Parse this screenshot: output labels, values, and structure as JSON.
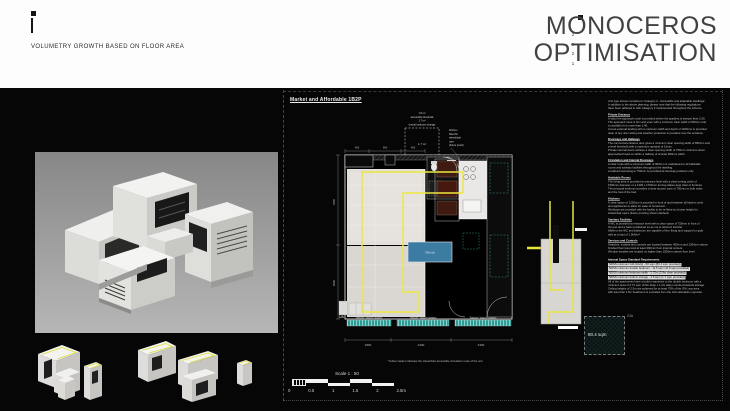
{
  "header": {
    "subtitle": "VOLUMETRY GROWTH BASED ON FLOOR AREA",
    "title_line1": "MONOCEROS",
    "title_line2": "OPTIMISATION",
    "year_digits": [
      "2",
      "0",
      "2",
      "1"
    ]
  },
  "colors": {
    "accent_yellow": "#E8E33E",
    "window_teal": "#35A39A",
    "furniture_blue": "#3C7BA2",
    "kitchen_red": "#3E1A10",
    "render_grey": "#9B9B9B"
  },
  "plan": {
    "title": "Market and Affordable 1B2P",
    "ua": "UA",
    "window_label": "Window / balcony location",
    "blue_label": "750 min",
    "storage_box_label": "1.7 m²",
    "storage_notes": [
      "1.5 m²",
      "accessible threshold",
      "1.7 m²",
      "(extra) bedroom storage"
    ],
    "kitchen_note": [
      "Kitchen",
      "fitted for",
      "wheelchair",
      "user",
      "(future proof)"
    ],
    "dims_bottom": [
      "1800",
      "2400",
      "2300"
    ],
    "dims_left": [
      "3450",
      "2900"
    ],
    "dims_top": [
      "450",
      "900",
      "450"
    ]
  },
  "scalebar": {
    "label": "Scale 1 : 50",
    "ticks": [
      "0",
      "0.5",
      "1",
      "1.5",
      "2",
      "2.5m"
    ]
  },
  "note": "*Yellow marker indicates the wheelchair accessible circulation route of the unit",
  "gia_square": {
    "label": "80.4 sqm",
    "corner": "GIA"
  },
  "annotations": {
    "items": [
      {
        "cls": "al",
        "text": "Unit type shown complies to 'Category 2 - Accessible and adaptable dwellings'."
      },
      {
        "cls": "al",
        "text": "In addition to the above planning, please note that the following regulations"
      },
      {
        "cls": "al",
        "text": "have been adhered to with Category 2 implemented throughout the scheme."
      },
      {
        "cls": "ah",
        "text": "Private Entrance"
      },
      {
        "cls": "al",
        "text": "A step free approach route is provided where the gradient is steeper than 1:60."
      },
      {
        "cls": "al",
        "text": "The approach route is firm and even with a minimum clear width of 900mm and"
      },
      {
        "cls": "al",
        "text": "a crossfall of no more than 1:40."
      },
      {
        "cls": "al",
        "text": "A level external landing with a minimum width and depth of 1200mm is provided"
      },
      {
        "cls": "al",
        "text": "clear of any door swing and weather protection is provided over the entrance."
      },
      {
        "cls": "ah",
        "text": "Doorways and Hallways"
      },
      {
        "cls": "al",
        "text": "The communal entrance door gives a minimum clear opening width of 850mm and"
      },
      {
        "cls": "al",
        "text": "a level threshold with a maximum upstand of 15mm."
      },
      {
        "cls": "al",
        "text": "Private internal doors achieve a clear opening width of 750mm minimum when"
      },
      {
        "cls": "al",
        "text": "approached head-on within a hallway of at least 900mm width."
      },
      {
        "cls": "ah",
        "text": "Circulation and Internal Doorways"
      },
      {
        "cls": "al",
        "text": "A clear route with a minimum width of 900mm is maintained to all habitable"
      },
      {
        "cls": "al",
        "text": "rooms and sanitary facilities throughout the dwelling."
      },
      {
        "cls": "al",
        "text": "Localised narrowing to 750mm is permitted at doorway positions only."
      },
      {
        "cls": "ah",
        "text": "Habitable Rooms"
      },
      {
        "cls": "al",
        "text": "The living area is provided at entrance level with a clear turning circle of"
      },
      {
        "cls": "al",
        "text": "1500mm diameter or a 1400 x 1700mm turning ellipse kept clear of furniture."
      },
      {
        "cls": "al",
        "text": "The principal bedroom provides a clear access zone of 750mm to both sides"
      },
      {
        "cls": "al",
        "text": "and the foot of the bed."
      },
      {
        "cls": "ah",
        "text": "Kitchens"
      },
      {
        "cls": "al",
        "text": "A clear space of 1200mm is provided in front of and between all kitchen units"
      },
      {
        "cls": "al",
        "text": "and appliances to allow for ease of movement."
      },
      {
        "cls": "al",
        "text": "Worktops are provided with the facility to be re-fitted at a lower height for"
      },
      {
        "cls": "al",
        "text": "wheelchair users (future proofing shown dashed)."
      },
      {
        "cls": "ah",
        "text": "Sanitary Facilities"
      },
      {
        "cls": "al",
        "text": "A WC is provided at entrance level with a clear space of 750mm in front of"
      },
      {
        "cls": "al",
        "text": "the pan and a basin positioned so as not to obstruct transfer."
      },
      {
        "cls": "al",
        "text": "Walls to the WC and bathroom are capable of firm fixing and support for grab"
      },
      {
        "cls": "al",
        "text": "rails at a load of 1.5kN/m²."
      },
      {
        "cls": "ah",
        "text": "Services and Controls"
      },
      {
        "cls": "al",
        "text": "Switches, sockets and controls are located between 450mm and 1200mm above"
      },
      {
        "cls": "al",
        "text": "finished floor level and at least 300mm from internal corners."
      },
      {
        "cls": "al",
        "text": "Window handles are located no higher than 1200mm above floor level."
      },
      {
        "cls": "ah2",
        "text": "Internal Space Standard Requirements"
      },
      {
        "cls": "hl",
        "text": "NDSS minimum GIA (1b2p) - 50 sqm (80.4 sqm provided)"
      },
      {
        "cls": "hl",
        "text": "NDSS minimum double bedroom - 11.5 sqm (11.9 sqm provided)"
      },
      {
        "cls": "hl",
        "text": "NDSS minimum bedroom width - 2.75m (2.8m clear provided)"
      },
      {
        "cls": "hl",
        "text": "NDSS minimum built-in storage - 1.5 sqm (1.7 sqm provided)"
      },
      {
        "cls": "al",
        "text": "All of the apartments have a built-in wardrobe to the double bedroom with a"
      },
      {
        "cls": "al",
        "text": "minimum area of 0.72 sqm (0.6m deep x 1.2m wide) counted towards storage."
      },
      {
        "cls": "al",
        "text": "Ceiling heights of 2.5m are achieved for at least 75% of the GIA; any area"
      },
      {
        "cls": "al",
        "text": "with less than 1.5m headroom is excluded from the GIA calculation opposite."
      }
    ]
  }
}
